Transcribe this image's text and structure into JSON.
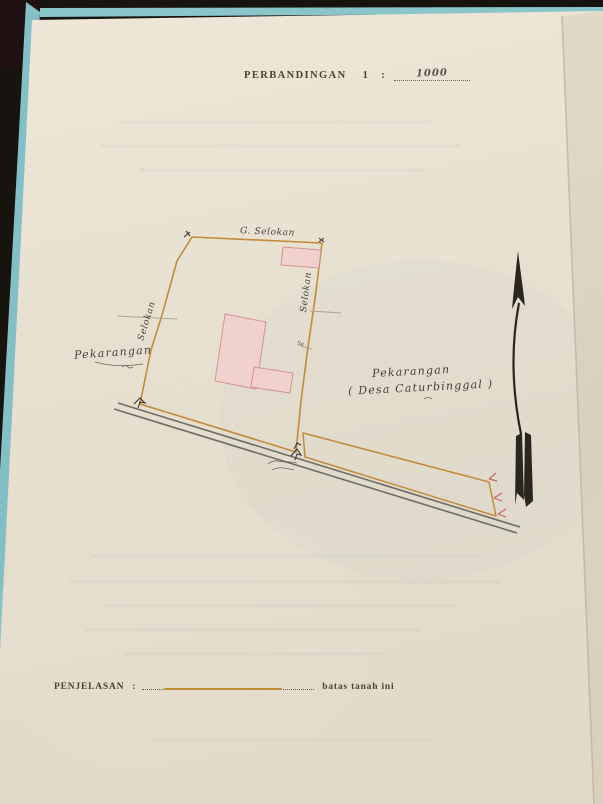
{
  "title": {
    "label": "PERBANDINGAN",
    "number": "1",
    "separator": ":",
    "scale_value": "1000"
  },
  "map": {
    "labels": {
      "top_edge": "G. Selokan",
      "left_edge": "Selokan",
      "right_edge": "Selokan",
      "left_area": "Pekarangan",
      "right_area_line1": "Pekarangan",
      "right_area_line2": "( Desa Caturbinggal )",
      "edge_mark": "5a"
    },
    "colors": {
      "boundary": "#c08c3c",
      "building_fill": "#f3d0cd",
      "building_outline": "#cf8e8c",
      "road": "#6e6d65",
      "survey_tick": "#c4504e",
      "ink": "#3a342c",
      "compass": "#2a251f",
      "paper": "#e9e2d2",
      "folder_edge": "#85bfc6"
    }
  },
  "legend": {
    "label": "PENJELASAN",
    "separator": ":",
    "description": "batas tanah ini"
  }
}
